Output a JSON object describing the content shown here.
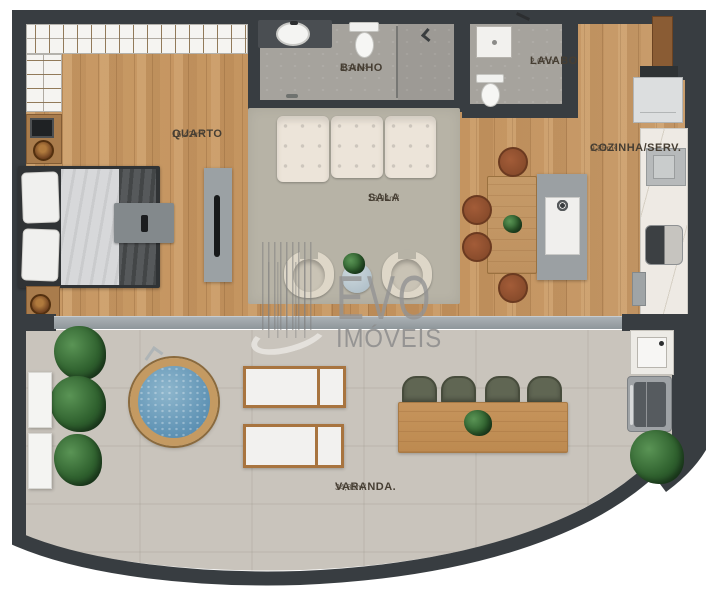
{
  "plan": {
    "rooms": {
      "quarto": {
        "name": "QUARTO",
        "area": "16,42m²"
      },
      "banho": {
        "name": "BANHO",
        "area": "4,34m²"
      },
      "lavabo": {
        "name": "LAVABO",
        "area": "2,07m²"
      },
      "sala": {
        "name": "SALA",
        "area": "13,94m²"
      },
      "cozinha": {
        "name": "COZINHA/SERV.",
        "area": "9,85m²"
      },
      "varanda": {
        "name": "VARANDA.",
        "area": "34,81m²"
      }
    },
    "watermark": {
      "brand": "EVO",
      "brand_suffix": "IMÓVEIS"
    },
    "palette": {
      "wall": "#383d41",
      "wood_floor": "#c79763",
      "concrete_floor": "#c9c4bc",
      "bath_floor": "#a6a39d",
      "rug": "#b7b3a6",
      "pool_water": "#6e9cbb",
      "marble_counter": "#eeeae4",
      "watermark_gray": "#949494"
    }
  }
}
